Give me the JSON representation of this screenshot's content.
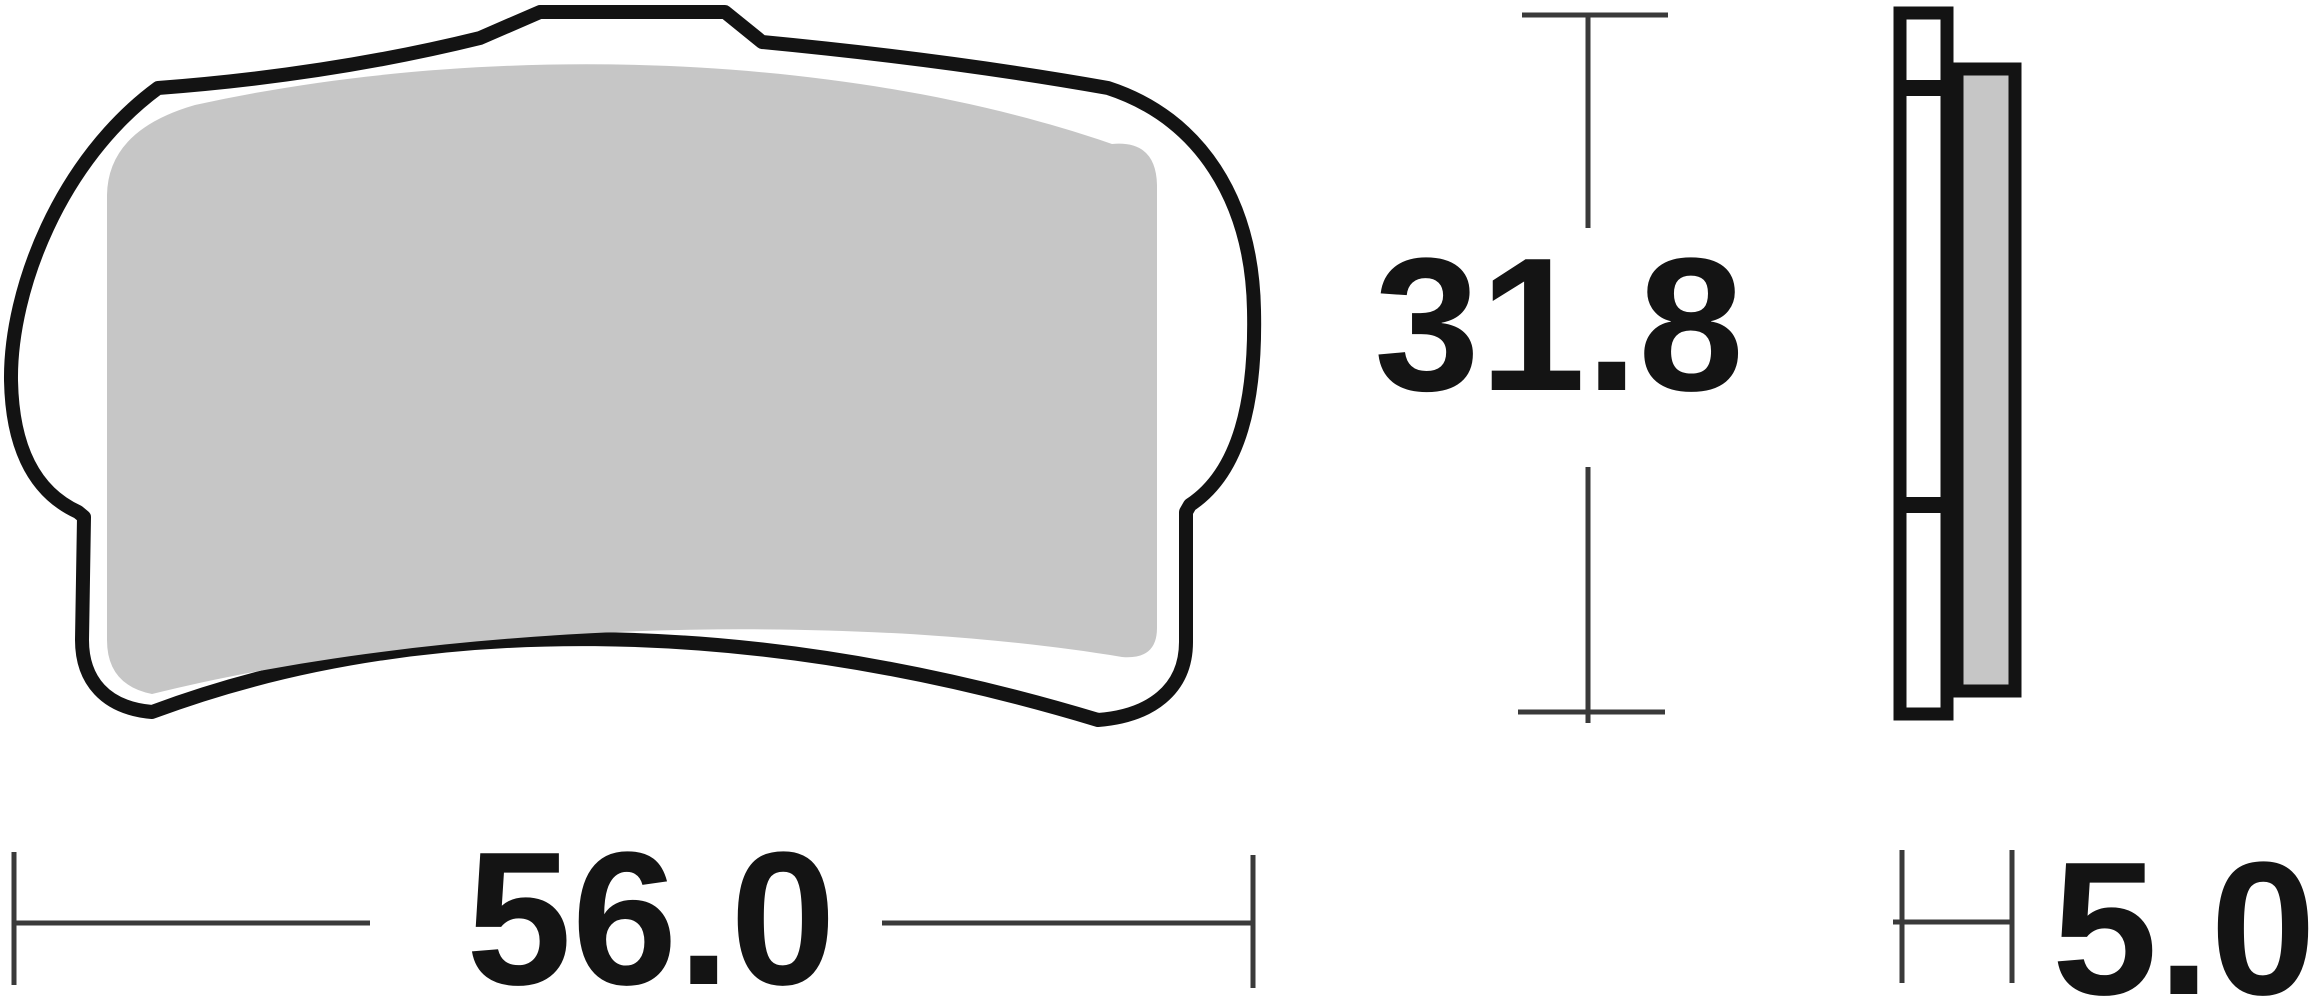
{
  "dimensions": {
    "width": "56.0",
    "height": "31.8",
    "thickness": "5.0"
  },
  "colors": {
    "outline": "#131313",
    "friction_material": "#c6c6c6",
    "backplate_fill": "#ffffff",
    "dimension_lines": "#3a3a3a",
    "label_text": "#141414",
    "background": "#ffffff"
  }
}
